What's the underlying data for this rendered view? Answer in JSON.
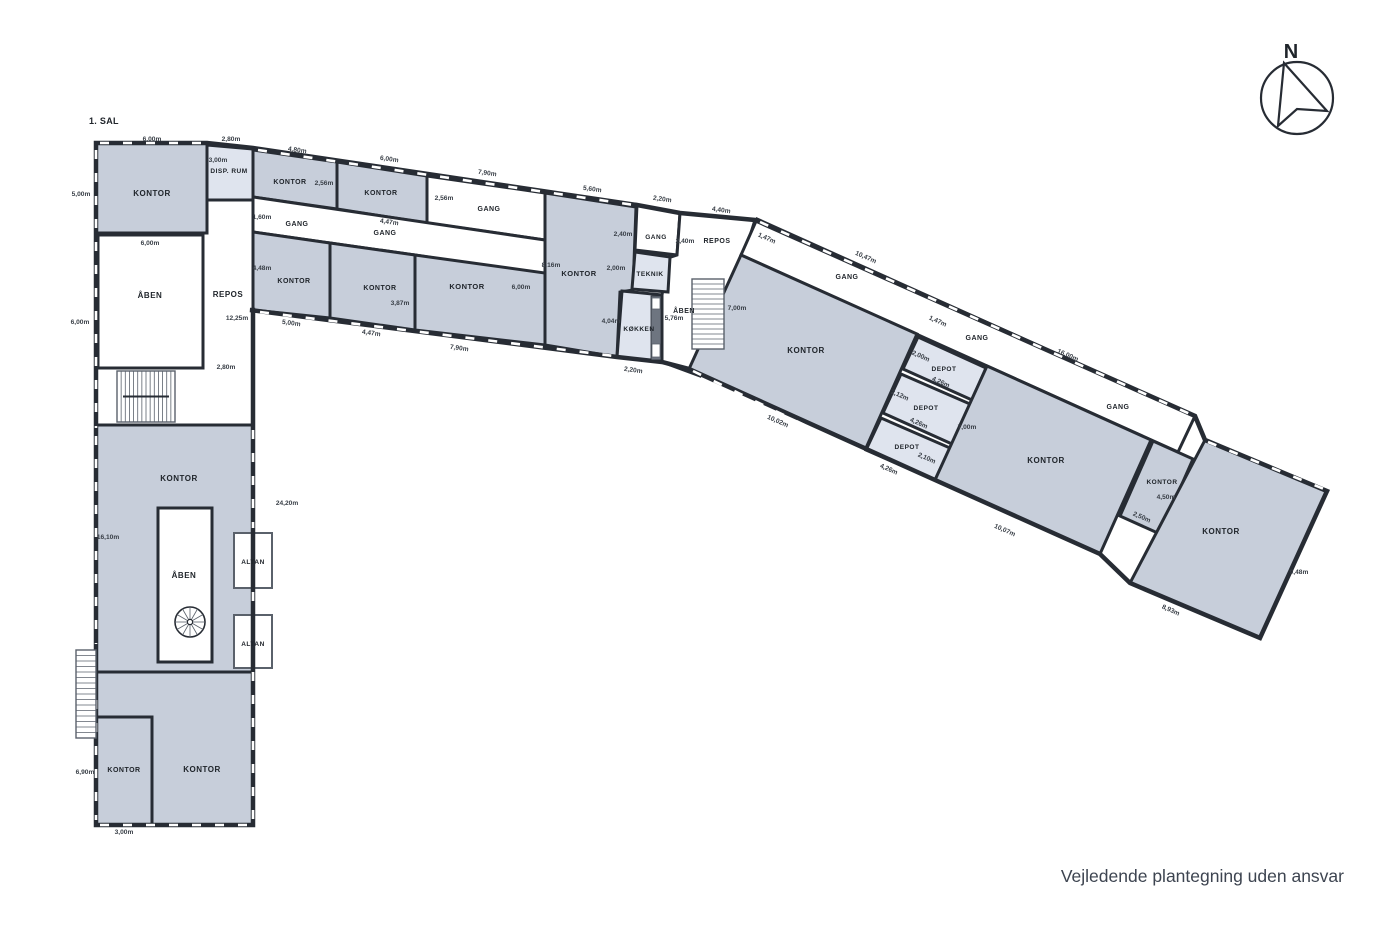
{
  "title": "1. SAL",
  "footer": "Vejledende plantegning uden ansvar",
  "compass_label": "N",
  "colors": {
    "room": "#c7ceda",
    "light": "#dfe4ee",
    "white": "#ffffff",
    "wall": "#272c34",
    "thin": "#5a616b",
    "counter": "#6e7580",
    "label": "#20252b",
    "dim": "#383e46"
  },
  "outline": "M96,143 L207,143 L253,148 L637,205 L680,213 L755,220 L1195,416 L1205,440 L1327,491 L1260,638 L1130,583 L1100,554 L935,480 L689,369 L662,362 L617,357 L250,310 L253,310 L253,825 L96,825 Z",
  "rooms": [
    {
      "id": "room-kontor-nw",
      "fill": "room",
      "pts": [
        [
          96,
          143
        ],
        [
          207,
          143
        ],
        [
          207,
          233
        ],
        [
          96,
          233
        ]
      ]
    },
    {
      "id": "room-disp-rum",
      "fill": "light",
      "pts": [
        [
          207,
          145
        ],
        [
          253,
          149
        ],
        [
          253,
          200
        ],
        [
          207,
          200
        ]
      ]
    },
    {
      "id": "room-aaben-nw",
      "fill": "white",
      "pts": [
        [
          98,
          235
        ],
        [
          203,
          235
        ],
        [
          203,
          368
        ],
        [
          98,
          368
        ]
      ]
    },
    {
      "id": "room-repos-west",
      "fill": "white",
      "pts": [
        [
          207,
          200
        ],
        [
          253,
          200
        ],
        [
          253,
          425
        ],
        [
          96,
          425
        ],
        [
          96,
          368
        ],
        [
          203,
          368
        ],
        [
          203,
          233
        ],
        [
          207,
          233
        ]
      ]
    },
    {
      "id": "room-kontor-west-big",
      "fill": "room",
      "pts": [
        [
          96,
          425
        ],
        [
          253,
          425
        ],
        [
          253,
          672
        ],
        [
          96,
          672
        ]
      ]
    },
    {
      "id": "room-kontor-sw-large",
      "fill": "room",
      "pts": [
        [
          96,
          672
        ],
        [
          253,
          672
        ],
        [
          253,
          825
        ],
        [
          152,
          825
        ],
        [
          152,
          717
        ],
        [
          96,
          717
        ]
      ]
    },
    {
      "id": "room-kontor-sw-small",
      "fill": "room",
      "pts": [
        [
          96,
          717
        ],
        [
          152,
          717
        ],
        [
          152,
          825
        ],
        [
          96,
          825
        ]
      ]
    },
    {
      "id": "room-aaben-void",
      "fill": "white",
      "pts": [
        [
          158,
          508
        ],
        [
          212,
          508
        ],
        [
          212,
          662
        ],
        [
          158,
          662
        ]
      ]
    },
    {
      "id": "room-altan-1",
      "fill": "white",
      "stroke": "thin",
      "sw": 2,
      "pts": [
        [
          234,
          533
        ],
        [
          272,
          533
        ],
        [
          272,
          588
        ],
        [
          234,
          588
        ]
      ]
    },
    {
      "id": "room-altan-2",
      "fill": "white",
      "stroke": "thin",
      "sw": 2,
      "pts": [
        [
          234,
          615
        ],
        [
          272,
          615
        ],
        [
          272,
          668
        ],
        [
          234,
          668
        ]
      ]
    },
    {
      "id": "room-kontor-t1",
      "fill": "room",
      "pts": [
        [
          253,
          150
        ],
        [
          337,
          162
        ],
        [
          337,
          209
        ],
        [
          253,
          197
        ]
      ]
    },
    {
      "id": "room-kontor-t2",
      "fill": "room",
      "pts": [
        [
          337,
          162
        ],
        [
          427,
          176
        ],
        [
          427,
          223
        ],
        [
          337,
          209
        ]
      ]
    },
    {
      "id": "room-gang-top",
      "fill": "white",
      "pts": [
        [
          427,
          176
        ],
        [
          545,
          193
        ],
        [
          545,
          240
        ],
        [
          427,
          223
        ]
      ]
    },
    {
      "id": "room-gang-corridor",
      "fill": "white",
      "pts": [
        [
          253,
          197
        ],
        [
          545,
          240
        ],
        [
          545,
          275
        ],
        [
          415,
          255
        ],
        [
          330,
          243
        ],
        [
          253,
          232
        ]
      ]
    },
    {
      "id": "room-kontor-t3",
      "fill": "room",
      "pts": [
        [
          253,
          232
        ],
        [
          330,
          243
        ],
        [
          330,
          318
        ],
        [
          253,
          310
        ]
      ]
    },
    {
      "id": "room-kontor-t4",
      "fill": "room",
      "pts": [
        [
          330,
          243
        ],
        [
          415,
          255
        ],
        [
          415,
          330
        ],
        [
          330,
          318
        ]
      ]
    },
    {
      "id": "room-kontor-t5",
      "fill": "room",
      "pts": [
        [
          415,
          255
        ],
        [
          545,
          273
        ],
        [
          545,
          345
        ],
        [
          415,
          330
        ]
      ]
    },
    {
      "id": "room-kontor-t6",
      "fill": "room",
      "pts": [
        [
          545,
          193
        ],
        [
          636,
          207
        ],
        [
          633,
          290
        ],
        [
          620,
          292
        ],
        [
          617,
          357
        ],
        [
          545,
          345
        ]
      ]
    },
    {
      "id": "room-gang-small",
      "fill": "white",
      "pts": [
        [
          637,
          205
        ],
        [
          680,
          213
        ],
        [
          677,
          255
        ],
        [
          635,
          250
        ]
      ]
    },
    {
      "id": "room-repos-mid",
      "fill": "white",
      "pts": [
        [
          680,
          213
        ],
        [
          755,
          220
        ],
        [
          745,
          252
        ],
        [
          700,
          376
        ],
        [
          662,
          362
        ],
        [
          662,
          295
        ],
        [
          668,
          258
        ],
        [
          677,
          255
        ]
      ]
    },
    {
      "id": "room-teknik",
      "fill": "light",
      "pts": [
        [
          635,
          252
        ],
        [
          670,
          257
        ],
        [
          668,
          292
        ],
        [
          632,
          289
        ]
      ]
    },
    {
      "id": "room-koekken",
      "fill": "light",
      "pts": [
        [
          622,
          291
        ],
        [
          662,
          295
        ],
        [
          662,
          362
        ],
        [
          617,
          357
        ]
      ]
    },
    {
      "id": "room-gang-right",
      "fill": "white",
      "pts": [
        [
          757,
          219
        ],
        [
          1195,
          416
        ],
        [
          1178,
          452
        ],
        [
          741,
          255
        ]
      ]
    },
    {
      "id": "room-kontor-r-big",
      "fill": "room",
      "pts": [
        [
          741,
          255
        ],
        [
          917,
          334
        ],
        [
          866,
          448
        ],
        [
          689,
          369
        ]
      ]
    },
    {
      "id": "room-depot-1",
      "fill": "light",
      "pts": [
        [
          918,
          337
        ],
        [
          986,
          368
        ],
        [
          972,
          400
        ],
        [
          903,
          369
        ]
      ]
    },
    {
      "id": "room-depot-2",
      "fill": "light",
      "pts": [
        [
          901,
          374
        ],
        [
          970,
          404
        ],
        [
          952,
          444
        ],
        [
          883,
          413
        ]
      ]
    },
    {
      "id": "room-depot-3",
      "fill": "light",
      "pts": [
        [
          881,
          418
        ],
        [
          950,
          448
        ],
        [
          935,
          480
        ],
        [
          866,
          450
        ]
      ]
    },
    {
      "id": "room-kontor-r2",
      "fill": "room",
      "pts": [
        [
          987,
          366
        ],
        [
          1151,
          440
        ],
        [
          1100,
          554
        ],
        [
          935,
          480
        ]
      ]
    },
    {
      "id": "room-kontor-r-small",
      "fill": "room",
      "pts": [
        [
          1153,
          441
        ],
        [
          1193,
          459
        ],
        [
          1160,
          534
        ],
        [
          1120,
          516
        ]
      ]
    },
    {
      "id": "room-kontor-r-far",
      "fill": "room",
      "pts": [
        [
          1205,
          440
        ],
        [
          1327,
          491
        ],
        [
          1260,
          638
        ],
        [
          1130,
          583
        ]
      ]
    }
  ],
  "windows": [
    [
      100,
      143,
      204,
      143
    ],
    [
      96,
      150,
      96,
      428
    ],
    [
      96,
      436,
      96,
      644
    ],
    [
      96,
      700,
      96,
      820
    ],
    [
      100,
      825,
      248,
      825
    ],
    [
      253,
      430,
      253,
      528
    ],
    [
      253,
      592,
      253,
      612
    ],
    [
      253,
      672,
      253,
      820
    ],
    [
      258,
      150,
      634,
      205
    ],
    [
      260,
      312,
      614,
      356
    ],
    [
      760,
      222,
      1190,
      414
    ],
    [
      693,
      371,
      1126,
      581
    ],
    [
      1208,
      442,
      1324,
      489
    ]
  ],
  "labels": [
    {
      "t": "KONTOR",
      "x": 152,
      "y": 196
    },
    {
      "t": "DISP. RUM",
      "x": 229,
      "y": 173,
      "s": 6.5
    },
    {
      "t": "ÅBEN",
      "x": 150,
      "y": 298
    },
    {
      "t": "REPOS",
      "x": 228,
      "y": 297
    },
    {
      "t": "KONTOR",
      "x": 179,
      "y": 481
    },
    {
      "t": "ÅBEN",
      "x": 184,
      "y": 578
    },
    {
      "t": "ALTAN",
      "x": 253,
      "y": 564,
      "s": 6.5
    },
    {
      "t": "ALTAN",
      "x": 253,
      "y": 646,
      "s": 6.5
    },
    {
      "t": "KONTOR",
      "x": 202,
      "y": 772
    },
    {
      "t": "KONTOR",
      "x": 124,
      "y": 772,
      "s": 7
    },
    {
      "t": "KONTOR",
      "x": 290,
      "y": 184,
      "s": 7
    },
    {
      "t": "KONTOR",
      "x": 381,
      "y": 195,
      "s": 7
    },
    {
      "t": "GANG",
      "x": 489,
      "y": 211,
      "s": 7
    },
    {
      "t": "GANG",
      "x": 297,
      "y": 226,
      "s": 7
    },
    {
      "t": "GANG",
      "x": 385,
      "y": 235,
      "s": 7
    },
    {
      "t": "KONTOR",
      "x": 294,
      "y": 283,
      "s": 7
    },
    {
      "t": "KONTOR",
      "x": 380,
      "y": 290,
      "s": 7
    },
    {
      "t": "KONTOR",
      "x": 467,
      "y": 289,
      "s": 7.5
    },
    {
      "t": "KONTOR",
      "x": 579,
      "y": 276,
      "s": 7.5
    },
    {
      "t": "GANG",
      "x": 656,
      "y": 239,
      "s": 6.5
    },
    {
      "t": "REPOS",
      "x": 717,
      "y": 243,
      "s": 7
    },
    {
      "t": "TEKNIK",
      "x": 650,
      "y": 276,
      "s": 6.5
    },
    {
      "t": "KØKKEN",
      "x": 639,
      "y": 331,
      "s": 6.5
    },
    {
      "t": "ÅBEN",
      "x": 684,
      "y": 313,
      "s": 7
    },
    {
      "t": "KONTOR",
      "x": 806,
      "y": 353
    },
    {
      "t": "DEPOT",
      "x": 944,
      "y": 371,
      "s": 6.5
    },
    {
      "t": "DEPOT",
      "x": 926,
      "y": 410,
      "s": 6.5
    },
    {
      "t": "DEPOT",
      "x": 907,
      "y": 449,
      "s": 6.5
    },
    {
      "t": "GANG",
      "x": 847,
      "y": 279,
      "s": 7
    },
    {
      "t": "GANG",
      "x": 977,
      "y": 340,
      "s": 7
    },
    {
      "t": "GANG",
      "x": 1118,
      "y": 409,
      "s": 7
    },
    {
      "t": "KONTOR",
      "x": 1046,
      "y": 463
    },
    {
      "t": "KONTOR",
      "x": 1162,
      "y": 484,
      "s": 6.5
    },
    {
      "t": "KONTOR",
      "x": 1221,
      "y": 534
    }
  ],
  "measurements": [
    {
      "t": "6,00m",
      "x": 152,
      "y": 141
    },
    {
      "t": "2,80m",
      "x": 231,
      "y": 141
    },
    {
      "t": "5,00m",
      "x": 81,
      "y": 196
    },
    {
      "t": "3,00m",
      "x": 218,
      "y": 162
    },
    {
      "t": "6,00m",
      "x": 150,
      "y": 245
    },
    {
      "t": "6,00m",
      "x": 80,
      "y": 324
    },
    {
      "t": "12,25m",
      "x": 237,
      "y": 320
    },
    {
      "t": "2,80m",
      "x": 226,
      "y": 369
    },
    {
      "t": "1,60m",
      "x": 262,
      "y": 219
    },
    {
      "t": "16,10m",
      "x": 108,
      "y": 539
    },
    {
      "t": "24,20m",
      "x": 287,
      "y": 505
    },
    {
      "t": "6,90m",
      "x": 85,
      "y": 774
    },
    {
      "t": "3,00m",
      "x": 124,
      "y": 834
    },
    {
      "t": "4,80m",
      "x": 297,
      "y": 152,
      "r": 8
    },
    {
      "t": "2,56m",
      "x": 324,
      "y": 185
    },
    {
      "t": "6,00m",
      "x": 389,
      "y": 161,
      "r": 8
    },
    {
      "t": "7,90m",
      "x": 487,
      "y": 175,
      "r": 8
    },
    {
      "t": "2,56m",
      "x": 444,
      "y": 200
    },
    {
      "t": "5,60m",
      "x": 592,
      "y": 191,
      "r": 8
    },
    {
      "t": "2,20m",
      "x": 662,
      "y": 201,
      "r": 8
    },
    {
      "t": "4,40m",
      "x": 721,
      "y": 212,
      "r": 8
    },
    {
      "t": "4,47m",
      "x": 389,
      "y": 224,
      "r": 8
    },
    {
      "t": "4,48m",
      "x": 262,
      "y": 270
    },
    {
      "t": "3,87m",
      "x": 400,
      "y": 305
    },
    {
      "t": "6,00m",
      "x": 521,
      "y": 289
    },
    {
      "t": "8,16m",
      "x": 551,
      "y": 267
    },
    {
      "t": "5,00m",
      "x": 291,
      "y": 325,
      "r": 8
    },
    {
      "t": "4,47m",
      "x": 371,
      "y": 335,
      "r": 8
    },
    {
      "t": "7,90m",
      "x": 459,
      "y": 350,
      "r": 8
    },
    {
      "t": "2,40m",
      "x": 623,
      "y": 236
    },
    {
      "t": "2,40m",
      "x": 685,
      "y": 243
    },
    {
      "t": "2,00m",
      "x": 616,
      "y": 270
    },
    {
      "t": "4,04m",
      "x": 611,
      "y": 323
    },
    {
      "t": "5,76m",
      "x": 674,
      "y": 320
    },
    {
      "t": "2,20m",
      "x": 633,
      "y": 372,
      "r": 8
    },
    {
      "t": "1,47m",
      "x": 766,
      "y": 240,
      "r": 24
    },
    {
      "t": "7,00m",
      "x": 737,
      "y": 310
    },
    {
      "t": "10,47m",
      "x": 865,
      "y": 259,
      "r": 24
    },
    {
      "t": "1,47m",
      "x": 937,
      "y": 323,
      "r": 24
    },
    {
      "t": "2,00m",
      "x": 920,
      "y": 358,
      "r": 24
    },
    {
      "t": "4,26m",
      "x": 940,
      "y": 384,
      "r": 24
    },
    {
      "t": "2,12m",
      "x": 899,
      "y": 397,
      "r": 24
    },
    {
      "t": "4,26m",
      "x": 918,
      "y": 425,
      "r": 24
    },
    {
      "t": "2,10m",
      "x": 926,
      "y": 460,
      "r": 24
    },
    {
      "t": "4,26m",
      "x": 888,
      "y": 471,
      "r": 24
    },
    {
      "t": "7,00m",
      "x": 967,
      "y": 429
    },
    {
      "t": "10,02m",
      "x": 777,
      "y": 423,
      "r": 24
    },
    {
      "t": "16,00m",
      "x": 1067,
      "y": 357,
      "r": 24
    },
    {
      "t": "10,07m",
      "x": 1004,
      "y": 532,
      "r": 24
    },
    {
      "t": "4,50m",
      "x": 1166,
      "y": 499
    },
    {
      "t": "2,50m",
      "x": 1141,
      "y": 519,
      "r": 24
    },
    {
      "t": "8,93m",
      "x": 1170,
      "y": 612,
      "r": 24
    },
    {
      "t": "9,48m",
      "x": 1299,
      "y": 574
    }
  ],
  "stairs": [
    {
      "id": "stair-west",
      "x": 117,
      "y": 371,
      "w": 58,
      "h": 51,
      "dir": "v",
      "treads": 14,
      "divider": true
    },
    {
      "id": "stair-mid",
      "x": 692,
      "y": 279,
      "w": 32,
      "h": 70,
      "dir": "h",
      "treads": 14,
      "divider": false
    },
    {
      "id": "stair-exterior",
      "x": 76,
      "y": 650,
      "w": 20,
      "h": 88,
      "dir": "h",
      "treads": 16,
      "divider": false
    }
  ],
  "spiral_stair": {
    "cx": 190,
    "cy": 622,
    "r": 15
  },
  "kitchen_counter": {
    "x": 651,
    "y": 296,
    "w": 10,
    "h": 64,
    "appliances": [
      {
        "x": 652,
        "y": 298,
        "w": 8,
        "h": 11
      },
      {
        "x": 652,
        "y": 344,
        "w": 8,
        "h": 13
      }
    ]
  }
}
